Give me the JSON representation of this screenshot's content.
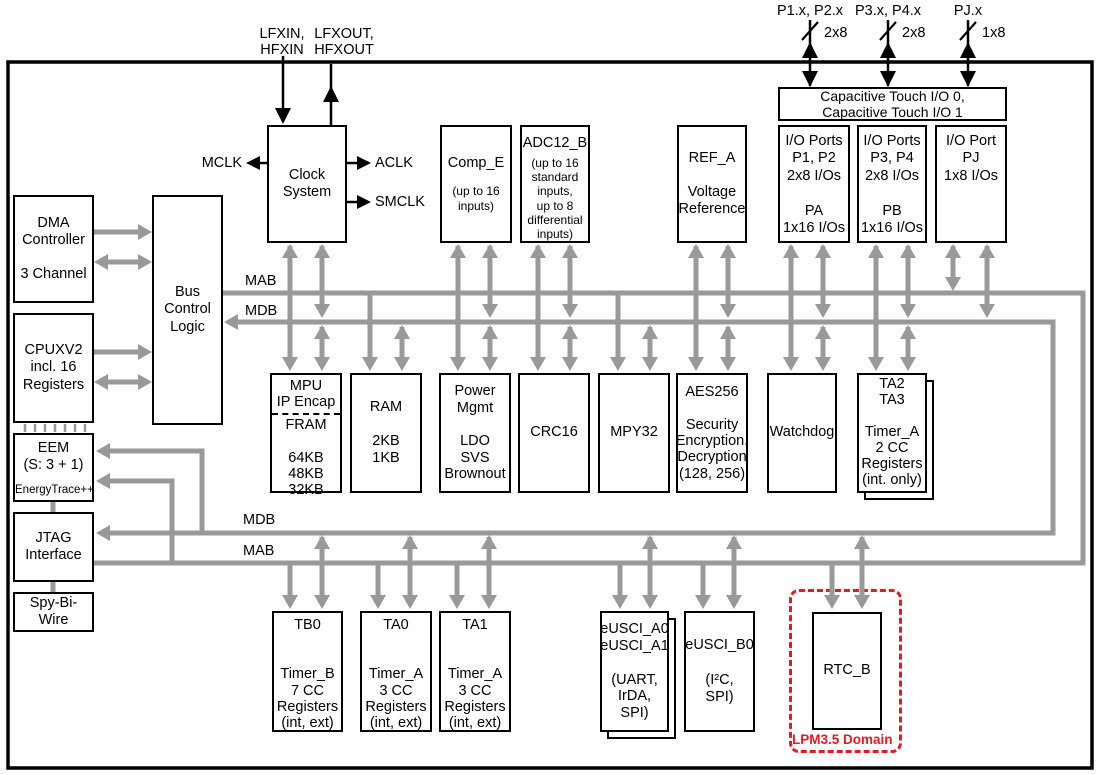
{
  "colors": {
    "arrow_gray": "#999999",
    "block_border": "#000000",
    "lpm_red": "#e01b24",
    "background": "#ffffff"
  },
  "external": {
    "lfxin": [
      "LFXIN,",
      "HFXIN"
    ],
    "lfxout": [
      "LFXOUT,",
      "HFXOUT"
    ],
    "p12": {
      "label": "P1.x, P2.x",
      "width": "2x8"
    },
    "p34": {
      "label": "P3.x, P4.x",
      "width": "2x8"
    },
    "pj": {
      "label": "PJ.x",
      "width": "1x8"
    }
  },
  "clock_signals": {
    "mclk": "MCLK",
    "aclk": "ACLK",
    "smclk": "SMCLK"
  },
  "bus": {
    "mab": "MAB",
    "mdb": "MDB"
  },
  "lpm_domain_label": "LPM3.5 Domain",
  "blocks": {
    "dma": {
      "lines": [
        "DMA",
        "Controller",
        "",
        "3 Channel"
      ]
    },
    "cpu": {
      "lines": [
        "CPUXV2",
        "incl. 16",
        "Registers"
      ]
    },
    "bcl": {
      "lines": [
        "Bus",
        "Control",
        "Logic"
      ]
    },
    "eem": {
      "lines": [
        "EEM",
        "(S: 3 + 1)"
      ],
      "footer": "EnergyTrace++"
    },
    "jtag": {
      "lines": [
        "JTAG",
        "Interface"
      ]
    },
    "sbw": {
      "lines": [
        "Spy-Bi-Wire"
      ]
    },
    "clock": {
      "lines": [
        "Clock",
        "System"
      ]
    },
    "comp": {
      "lines": [
        "Comp_E"
      ],
      "sub": [
        "(up to 16",
        "inputs)"
      ]
    },
    "adc": {
      "lines": [
        "ADC12_B"
      ],
      "sub": [
        "(up to 16",
        "standard",
        "inputs,",
        "up to 8",
        "differential",
        "inputs)"
      ]
    },
    "ref": {
      "lines": [
        "REF_A",
        "",
        "Voltage",
        "Reference"
      ]
    },
    "captouch": {
      "lines": [
        "Capacitive Touch I/O 0,",
        "Capacitive Touch I/O 1"
      ]
    },
    "port12": {
      "lines": [
        "I/O Ports",
        "P1, P2",
        "2x8 I/Os",
        "",
        "PA",
        "1x16 I/Os"
      ]
    },
    "port34": {
      "lines": [
        "I/O Ports",
        "P3, P4",
        "2x8 I/Os",
        "",
        "PB",
        "1x16 I/Os"
      ]
    },
    "portj": {
      "lines": [
        "I/O Port",
        "PJ",
        "1x8 I/Os"
      ]
    },
    "mpu": {
      "top": [
        "MPU",
        "IP Encap"
      ],
      "bottom": [
        "FRAM",
        "",
        "64KB",
        "48KB",
        "32KB"
      ]
    },
    "ram": {
      "lines": [
        "RAM",
        "",
        "2KB",
        "1KB"
      ]
    },
    "pwr": {
      "lines": [
        "Power",
        "Mgmt",
        "",
        "LDO",
        "SVS",
        "Brownout"
      ]
    },
    "crc": {
      "lines": [
        "CRC16"
      ]
    },
    "mpy": {
      "lines": [
        "MPY32"
      ]
    },
    "aes": {
      "lines": [
        "AES256",
        "",
        "Security",
        "Encryption,",
        "Decryption",
        "(128, 256)"
      ]
    },
    "wdt": {
      "lines": [
        "Watchdog"
      ]
    },
    "ta23": {
      "lines": [
        "TA2",
        "TA3",
        "",
        "Timer_A",
        "2 CC",
        "Registers",
        "(int. only)"
      ]
    },
    "tb0": {
      "lines": [
        "TB0",
        "",
        "",
        "Timer_B",
        "7 CC",
        "Registers",
        "(int, ext)"
      ]
    },
    "ta0": {
      "lines": [
        "TA0",
        "",
        "",
        "Timer_A",
        "3 CC",
        "Registers",
        "(int, ext)"
      ]
    },
    "ta1": {
      "lines": [
        "TA1",
        "",
        "",
        "Timer_A",
        "3 CC",
        "Registers",
        "(int, ext)"
      ]
    },
    "usci_a": {
      "lines": [
        "eUSCI_A0",
        "eUSCI_A1",
        "",
        "(UART,",
        "IrDA,",
        "SPI)"
      ]
    },
    "usci_b": {
      "lines": [
        "eUSCI_B0",
        "",
        "(I²C,",
        "SPI)"
      ]
    },
    "rtc": {
      "lines": [
        "RTC_B"
      ]
    }
  }
}
